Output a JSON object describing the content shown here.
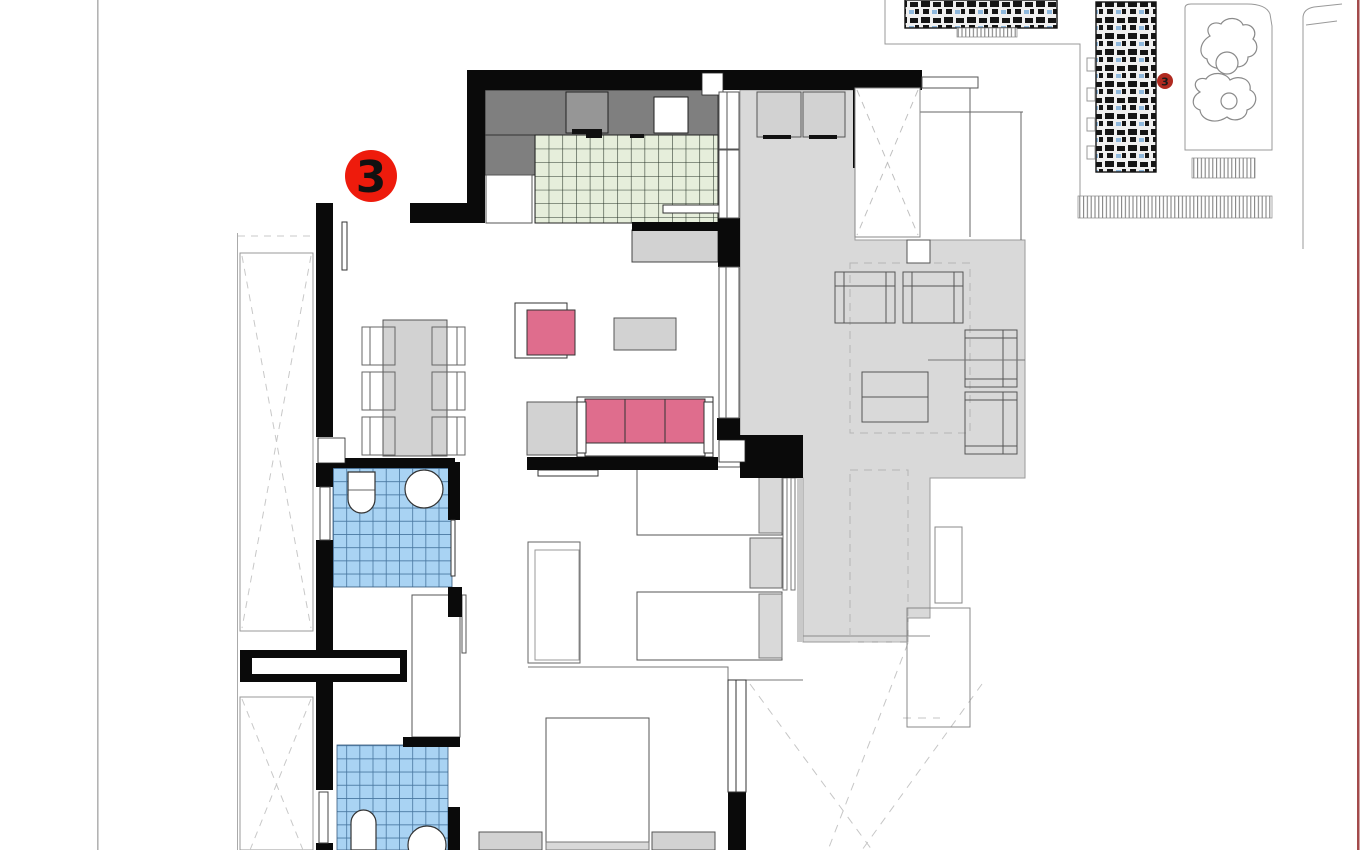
{
  "sheet": {
    "background": "#ffffff",
    "left_edge_color": "#b3b3b3",
    "right_edge_color": "#a34a4b"
  },
  "floor_plan": {
    "unit_marker": {
      "label": "3",
      "fill": "#ee1b0c",
      "text_color": "#111111"
    }
  },
  "site_plan": {
    "unit_marker": {
      "label": "3",
      "fill": "#b02a20",
      "text_color": "#1a1a1a"
    }
  },
  "palette": {
    "wall_black": "#0a0a0a",
    "terrace_floor_gray": "#d9d9d9",
    "kitchen_counter_gray": "#7f7f7f",
    "kitchen_tile_green": "#e6eedb",
    "bath_tile_blue": "#a9d3f3",
    "bath_tile_grid_blue": "#47769f",
    "upholstery_pink": "#df6d8d",
    "furniture_gray": "#d2d2d2"
  }
}
